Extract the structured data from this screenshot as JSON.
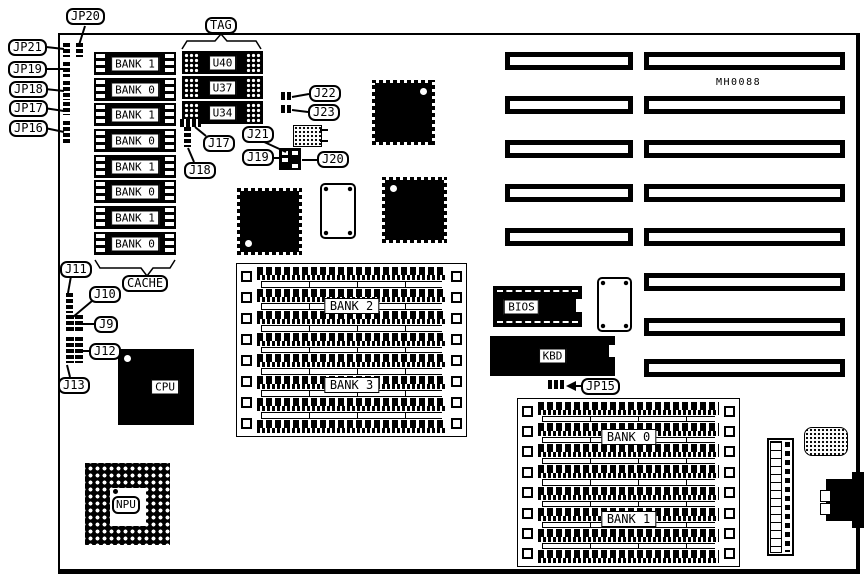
{
  "board": {
    "part_number": "MH0088"
  },
  "callouts": {
    "jp20": "JP20",
    "jp21": "JP21",
    "jp19": "JP19",
    "jp18": "JP18",
    "jp17": "JP17",
    "jp16": "JP16",
    "tag": "TAG",
    "cache": "CACHE",
    "j22": "J22",
    "j23": "J23",
    "j21": "J21",
    "j19": "J19",
    "j20": "J20",
    "j17": "J17",
    "j18": "J18",
    "j11": "J11",
    "j10": "J10",
    "j9": "J9",
    "j12": "J12",
    "j13": "J13",
    "jp15": "JP15"
  },
  "cache_bank": {
    "rows": [
      "BANK 1",
      "BANK 0",
      "BANK 1",
      "BANK 0",
      "BANK 1",
      "BANK 0",
      "BANK 1",
      "BANK 0"
    ]
  },
  "tag_chips": {
    "u40": "U40",
    "u37": "U37",
    "u34": "U34"
  },
  "chips": {
    "bios": "BIOS",
    "kbd": "KBD",
    "cpu": "CPU",
    "npu": "NPU"
  },
  "simm_top": {
    "upper": "BANK 2",
    "lower": "BANK 3"
  },
  "simm_bottom": {
    "upper": "BANK 0",
    "lower": "BANK 1"
  }
}
